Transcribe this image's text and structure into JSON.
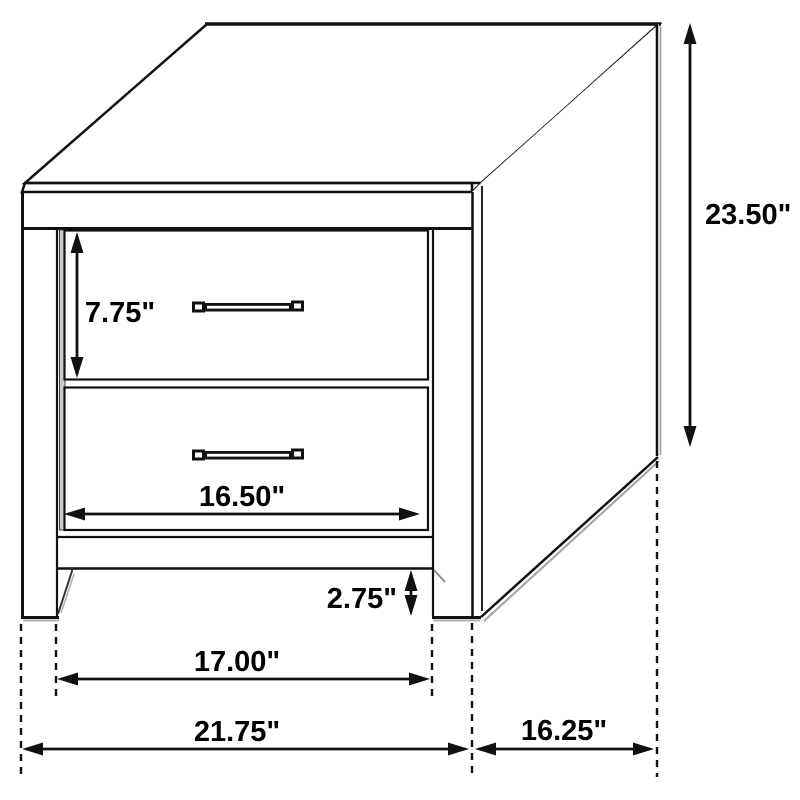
{
  "diagram": {
    "subject": "two-drawer nightstand isometric dimension drawing",
    "labels": {
      "height": "23.50\"",
      "drawer_height": "7.75\"",
      "drawer_width": "16.50\"",
      "base_height": "2.75\"",
      "leg_inner_span": "17.00\"",
      "overall_width": "21.75\"",
      "depth": "16.25\""
    },
    "colors": {
      "line": "#111111",
      "background": "#ffffff",
      "reveal_gray": "#c9c9c9",
      "shadow_gray": "#a6a6a6"
    }
  }
}
